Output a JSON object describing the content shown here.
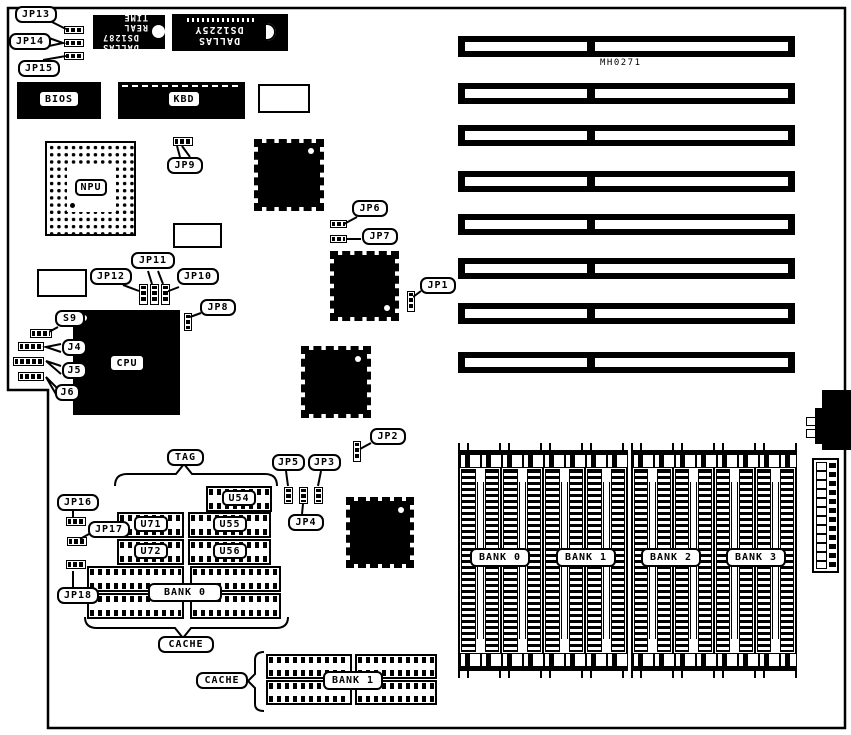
{
  "board": {
    "code": "MH0271",
    "callouts": {
      "jp1": "JP1",
      "jp2": "JP2",
      "jp3": "JP3",
      "jp4": "JP4",
      "jp5": "JP5",
      "jp6": "JP6",
      "jp7": "JP7",
      "jp8": "JP8",
      "jp9": "JP9",
      "jp10": "JP10",
      "jp11": "JP11",
      "jp12": "JP12",
      "jp13": "JP13",
      "jp14": "JP14",
      "jp15": "JP15",
      "jp16": "JP16",
      "jp17": "JP17",
      "jp18": "JP18",
      "s9": "S9",
      "j4": "J4",
      "j5": "J5",
      "j6": "J6",
      "tag": "TAG",
      "cache_a": "CACHE",
      "cache_b": "CACHE"
    },
    "chips": {
      "bios": "BIOS",
      "kbd": "KBD",
      "npu": "NPU",
      "cpu": "CPU",
      "u54": "U54",
      "u71": "U71",
      "u55": "U55",
      "u72": "U72",
      "u56": "U56"
    },
    "rtc": {
      "brand": "DALLAS",
      "part": "DS1287",
      "subtitle": "REAL TIME"
    },
    "nvram": {
      "brand": "DALLAS",
      "part": "DS1225Y"
    },
    "cache": {
      "bank0": "BANK 0",
      "bank1": "BANK 1"
    },
    "memory": {
      "banks": [
        "BANK 0",
        "BANK 1",
        "BANK 2",
        "BANK 3"
      ]
    }
  }
}
